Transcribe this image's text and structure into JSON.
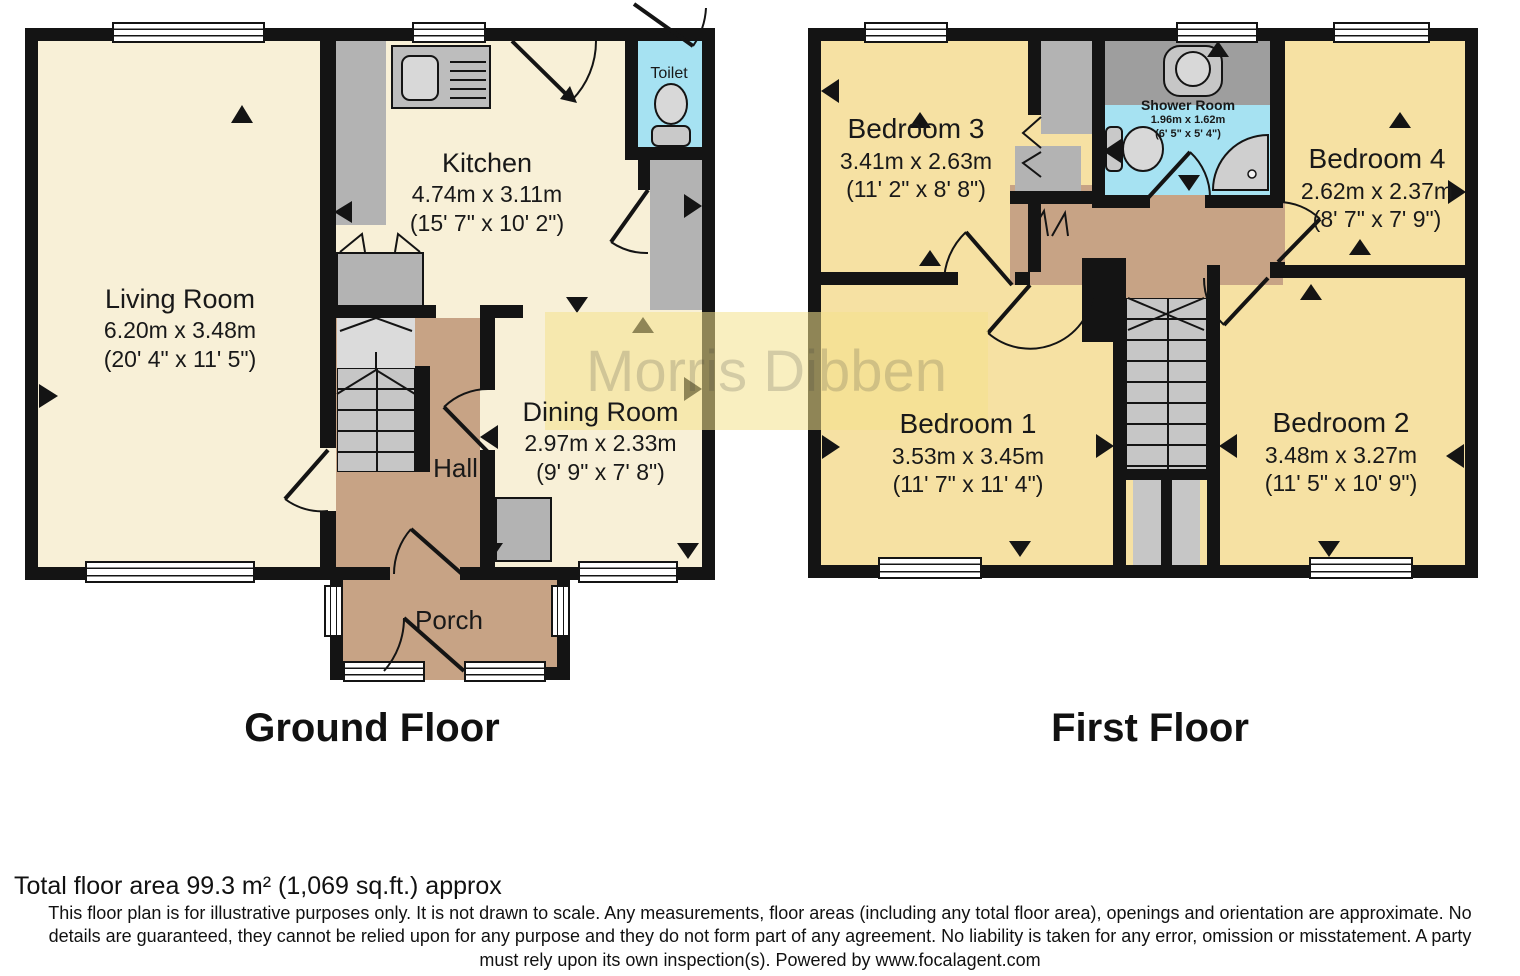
{
  "watermark": "Morris Dibben",
  "ground_floor": {
    "title": "Ground Floor",
    "living_room": {
      "name": "Living Room",
      "metric": "6.20m x 3.48m",
      "imperial": "(20' 4\" x 11' 5\")"
    },
    "kitchen": {
      "name": "Kitchen",
      "metric": "4.74m x 3.11m",
      "imperial": "(15' 7\" x 10' 2\")"
    },
    "dining_room": {
      "name": "Dining Room",
      "metric": "2.97m x 2.33m",
      "imperial": "(9' 9\" x 7' 8\")"
    },
    "hall": {
      "name": "Hall"
    },
    "porch": {
      "name": "Porch"
    },
    "toilet": {
      "name": "Toilet"
    }
  },
  "first_floor": {
    "title": "First Floor",
    "bedroom1": {
      "name": "Bedroom 1",
      "metric": "3.53m x 3.45m",
      "imperial": "(11' 7\" x 11' 4\")"
    },
    "bedroom2": {
      "name": "Bedroom 2",
      "metric": "3.48m x 3.27m",
      "imperial": "(11' 5\" x 10' 9\")"
    },
    "bedroom3": {
      "name": "Bedroom 3",
      "metric": "3.41m x 2.63m",
      "imperial": "(11' 2\" x 8' 8\")"
    },
    "bedroom4": {
      "name": "Bedroom 4",
      "metric": "2.62m x 2.37m",
      "imperial": "(8' 7\" x 7' 9\")"
    },
    "shower_room": {
      "name": "Shower Room",
      "metric": "1.96m x 1.62m",
      "imperial": "(6' 5\" x 5' 4\")"
    }
  },
  "footer": {
    "total_area": "Total floor area 99.3 m² (1,069 sq.ft.) approx",
    "disclaimer_lines": [
      "This floor plan is for illustrative purposes only. It is not drawn to scale. Any measurements, floor areas (including any total floor area), openings and orientation are approximate. No",
      "details are guaranteed, they cannot be relied upon for any purpose and they do not form part of any agreement. No liability is taken for any error, omission or misstatement. A party",
      "must rely upon its own inspection(s). Powered by www.focalagent.com"
    ]
  },
  "colors": {
    "wall": "#141414",
    "ground_room": "#F8F0D7",
    "bedroom": "#F6E1A3",
    "hallway": "#C7A385",
    "wet_room": "#A6E2F2",
    "fixture_gray": "#B3B3B3",
    "watermark_band": "#F4E18D"
  }
}
